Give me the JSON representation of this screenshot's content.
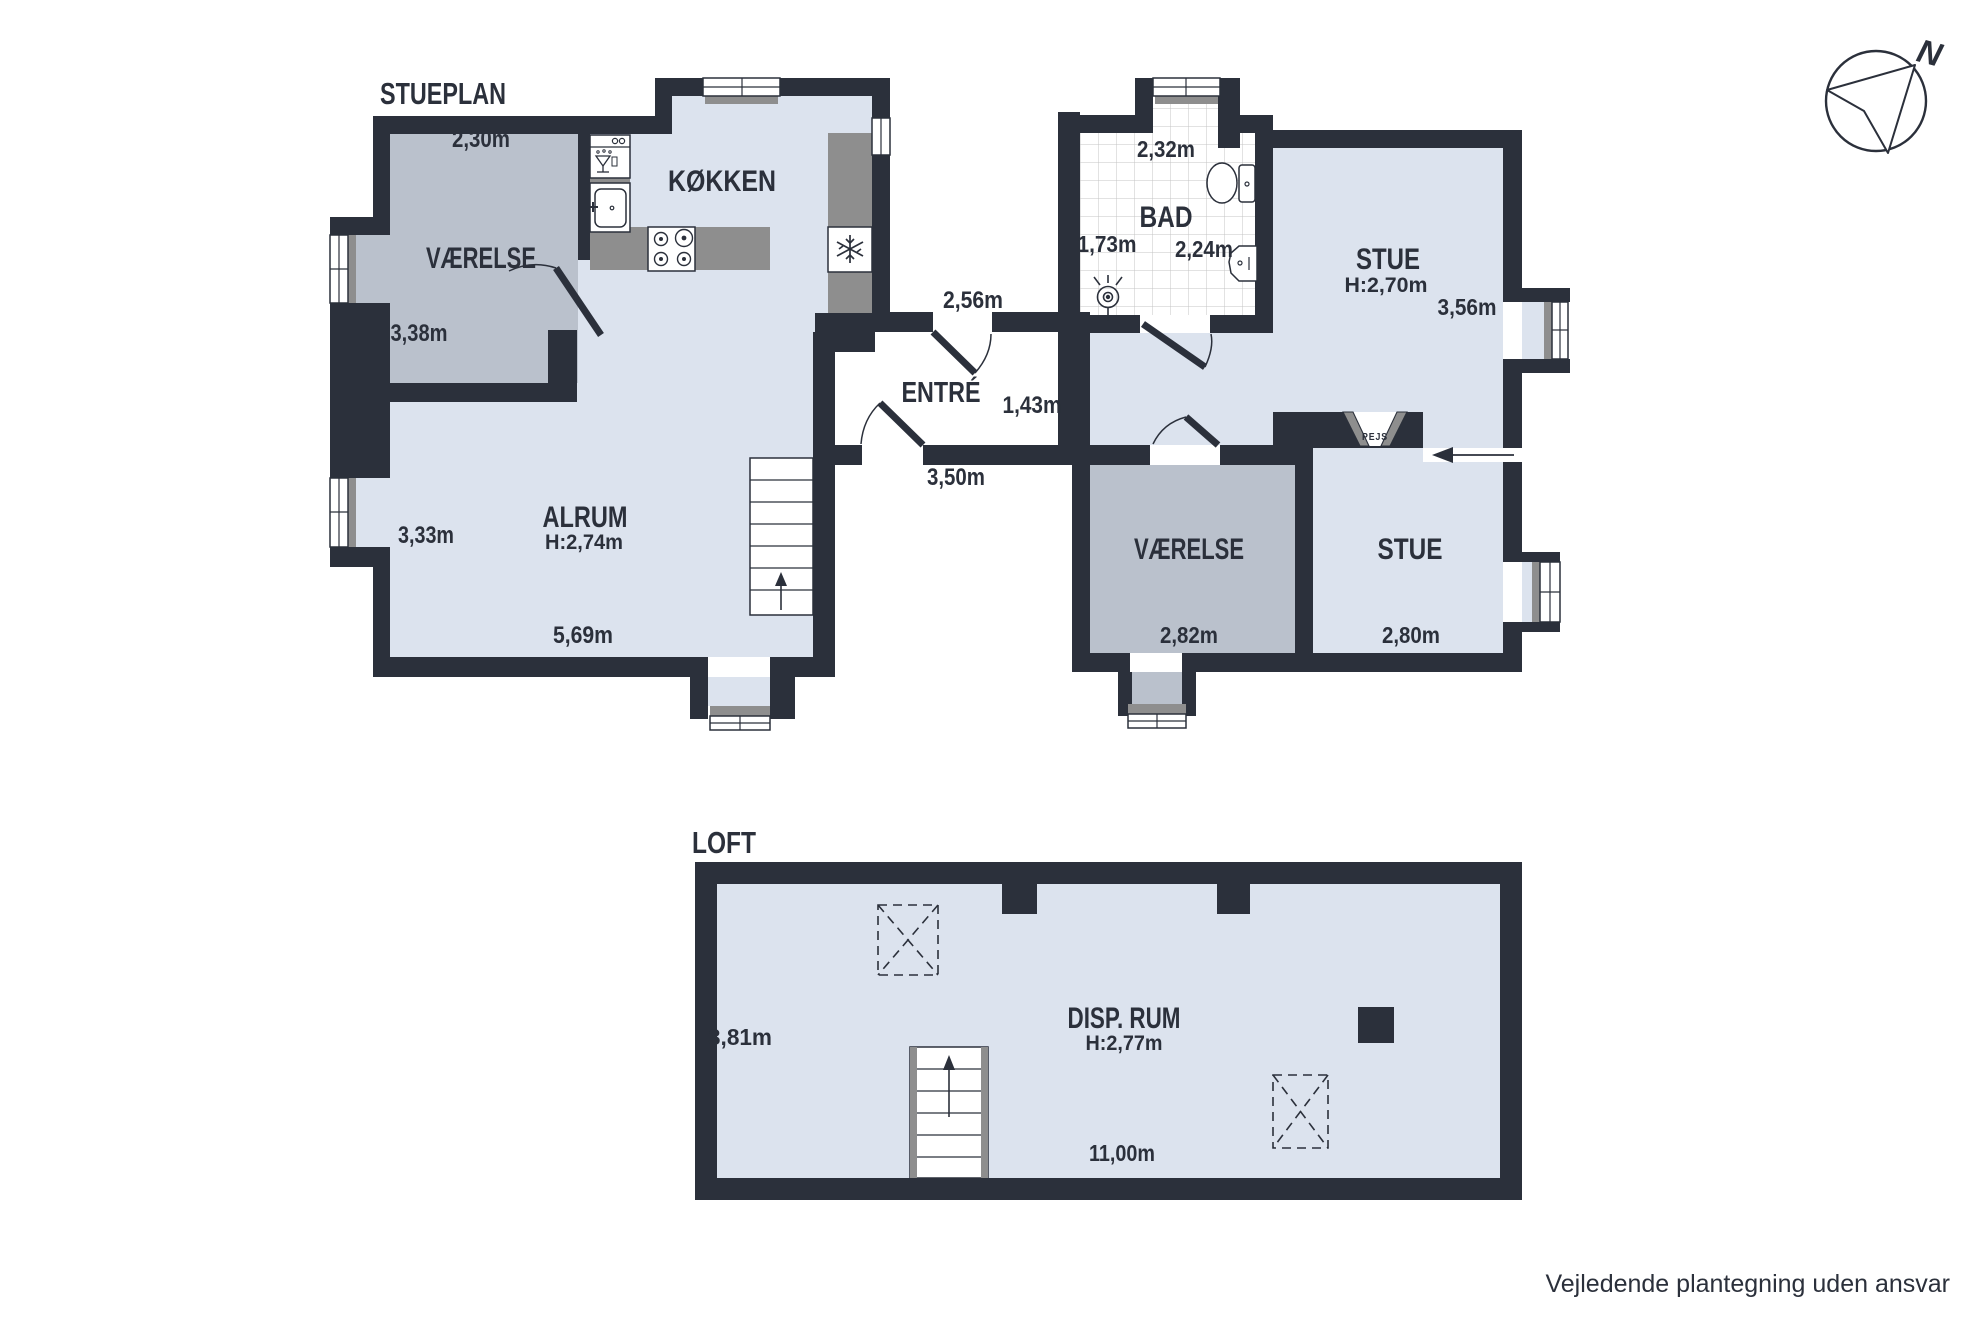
{
  "header": {
    "stueplan_label": "STUEPLAN",
    "loft_label": "LOFT"
  },
  "stueplan": {
    "vaerelse_nw": {
      "name": "VÆRELSE",
      "width": "2,30m",
      "depth": "3,38m"
    },
    "koekken": {
      "name": "KØKKEN"
    },
    "alrum": {
      "name": "ALRUM",
      "ceiling": "H:2,74m",
      "depth": "3,33m",
      "width": "5,69m"
    },
    "entre": {
      "name": "ENTRÉ",
      "dim_top": "2,56m",
      "dim_right": "1,43m",
      "dim_bottom": "3,50m"
    },
    "bad": {
      "name": "BAD",
      "dim_top": "2,32m",
      "dim_left": "1,73m",
      "dim_right": "2,24m"
    },
    "stue_ne": {
      "name": "STUE",
      "ceiling": "H:2,70m",
      "depth": "3,56m"
    },
    "vaerelse_se": {
      "name": "VÆRELSE",
      "width": "2,82m"
    },
    "stue_se": {
      "name": "STUE",
      "width": "2,80m"
    },
    "pejs": {
      "label": "PEJS"
    }
  },
  "loft": {
    "disp_rum": {
      "name": "DISP. RUM",
      "ceiling": "H:2,77m",
      "depth": "3,81m",
      "width": "11,00m"
    }
  },
  "compass": {
    "north_label": "N"
  },
  "footer": {
    "disclaimer": "Vejledende plantegning uden ansvar"
  },
  "colors": {
    "wall": "#2b303b",
    "floor_light": "#dce3ee",
    "room_gray": "#bac1cc",
    "counter_gray": "#8e8e8e",
    "tile_line": "#c4c4c4"
  }
}
